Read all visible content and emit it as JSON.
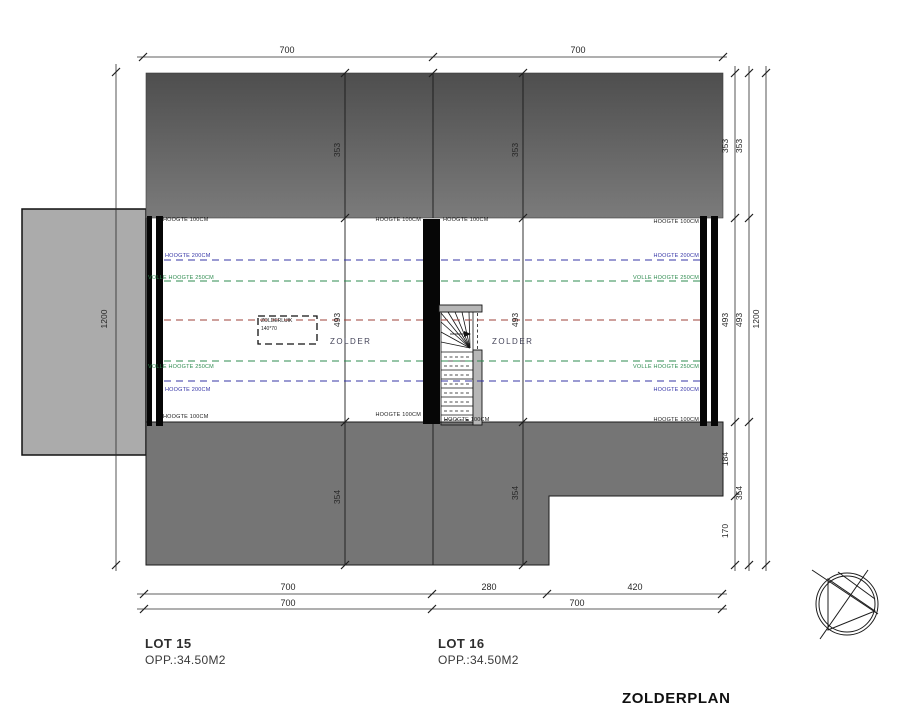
{
  "title": "ZOLDERPLAN",
  "lots": {
    "lot15": {
      "name": "LOT 15",
      "area": "OPP.:34.50M2",
      "room": "ZOLDER"
    },
    "lot16": {
      "name": "LOT 16",
      "area": "OPP.:34.50M2",
      "room": "ZOLDER"
    }
  },
  "hatch": {
    "name": "ZOLDERLUIK",
    "size": "140*70"
  },
  "labels": {
    "h100": "HOOGTE 100CM",
    "h200": "HOOGTE 200CM",
    "h250": "VOLLE HOOGTE 250CM"
  },
  "dims": {
    "top": [
      "700",
      "700"
    ],
    "bottom_row1": [
      "700",
      "280",
      "420"
    ],
    "bottom_row2": [
      "700",
      "700"
    ],
    "left_overall": "1200",
    "right_inner": [
      "353",
      "493",
      "184",
      "170"
    ],
    "right_mid": [
      "353",
      "493",
      "354"
    ],
    "right_overall": "1200",
    "roof_top": [
      "353",
      "353"
    ],
    "floor": [
      "493",
      "493"
    ],
    "roof_bottom": [
      "354",
      "354"
    ]
  },
  "colors": {
    "line_blue": "#3434a6",
    "line_green": "#2e8b4f",
    "line_red": "#9e4038",
    "roof_top_start": "#4e4e4e",
    "roof_top_end": "#7b7b7b",
    "roof_bottom": "#757575",
    "annex": "#ababab",
    "stair_wall": "#b6b6b6"
  }
}
